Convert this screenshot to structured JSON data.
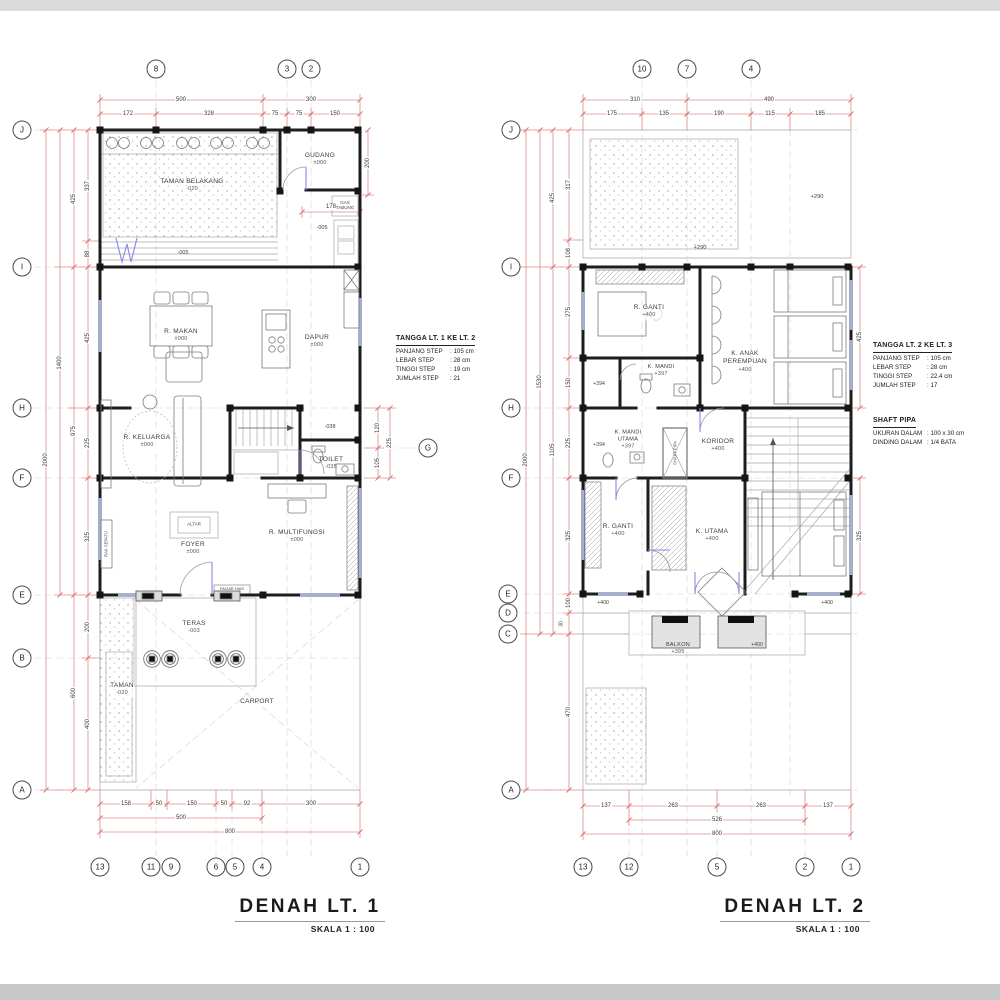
{
  "left": {
    "title": "DENAH LT. 1",
    "scale": "SKALA 1 : 100",
    "bubbles_top": [
      "8",
      "3",
      "2"
    ],
    "bubbles_bottom": [
      "13",
      "11",
      "9",
      "6",
      "5",
      "4",
      "1"
    ],
    "rows": [
      "J",
      "I",
      "H",
      "F",
      "E",
      "B",
      "A"
    ],
    "row_right": "G",
    "dims_top": [
      "500",
      "300"
    ],
    "dims_top2": [
      "172",
      "328",
      "75",
      "75",
      "150"
    ],
    "dims_bottom": [
      "158",
      "50",
      "150",
      "50",
      "92",
      "300"
    ],
    "dims_bottom2": [
      "500",
      "800"
    ],
    "dims_left": [
      "337",
      "88",
      "425",
      "225",
      "325",
      "200",
      "400"
    ],
    "dims_left2": [
      "425",
      "975",
      "600"
    ],
    "dim_span1": "1400",
    "dim_span2": "2000",
    "dims_right": [
      "200",
      "178",
      "120",
      "225",
      "105"
    ],
    "rooms": [
      {
        "n": "TAMAN BELAKANG",
        "l": "-020"
      },
      {
        "n": "GUDANG",
        "l": "±000"
      },
      {
        "n": "R. MAKAN",
        "l": "±000"
      },
      {
        "n": "DAPUR",
        "l": "±000"
      },
      {
        "n": "R. KELUARGA",
        "l": "±000"
      },
      {
        "n": "TOILET",
        "l": "-035"
      },
      {
        "n": "FOYER",
        "l": "±000"
      },
      {
        "n": "R. MULTIFUNGSI",
        "l": "±000"
      },
      {
        "n": "TERAS",
        "l": "-003"
      },
      {
        "n": "TAMAN",
        "l": "-020"
      },
      {
        "n": "CARPORT",
        "l": ""
      }
    ],
    "labels": {
      "gas1": "GAS",
      "gas2": "TABUNG",
      "deck": "-005",
      "deck2": "-005",
      "hall": "-038",
      "rak": "RAK SEPATU",
      "altar": "ALTAR",
      "pagar": "PAGAR HIAS"
    },
    "stair_note": {
      "title": "TANGGA LT. 1 KE LT. 2",
      "rows": [
        {
          "k": "PANJANG STEP",
          "v": ": 105 cm"
        },
        {
          "k": "LEBAR STEP",
          "v": ": 28 cm"
        },
        {
          "k": "TINGGI STEP",
          "v": ": 19 cm"
        },
        {
          "k": "JUMLAH STEP",
          "v": ": 21"
        }
      ]
    }
  },
  "right": {
    "title": "DENAH LT. 2",
    "scale": "SKALA 1 : 100",
    "bubbles_top": [
      "10",
      "7",
      "4"
    ],
    "bubbles_bottom": [
      "13",
      "12",
      "5",
      "2",
      "1"
    ],
    "rows": [
      "J",
      "I",
      "H",
      "F",
      "E",
      "D",
      "C",
      "A"
    ],
    "dims_top": [
      "310",
      "490"
    ],
    "dims_top2": [
      "175",
      "135",
      "190",
      "115",
      "185"
    ],
    "dims_bottom": [
      "137",
      "263",
      "263",
      "137"
    ],
    "dims_bottom2": [
      "526",
      "800"
    ],
    "dims_left": [
      "317",
      "108",
      "275",
      "150",
      "225",
      "325",
      "100",
      "30",
      "470"
    ],
    "dims_left2": [
      "425",
      "1105"
    ],
    "dim_span1": "1530",
    "dim_span2": "2000",
    "dims_right": [
      "425",
      "325"
    ],
    "rooms": [
      {
        "n": "R. GANTI",
        "l": "+400"
      },
      {
        "n": "K. MANDI",
        "l": "+397"
      },
      {
        "n": "K. ANAK",
        "n2": "PEREMPUAN",
        "l": "+400"
      },
      {
        "n": "K. MANDI",
        "n2": "UTAMA",
        "l": "+397"
      },
      {
        "n": "KORIDOR",
        "l": "+400"
      },
      {
        "n": "R. GANTI",
        "l": "+400"
      },
      {
        "n": "K. UTAMA",
        "l": "+400"
      },
      {
        "n": "BALKON",
        "l": "+395"
      }
    ],
    "levels": [
      "+290",
      "+290",
      "+394",
      "+394",
      "+400",
      "+400",
      "+400"
    ],
    "labels": {
      "shaft": "SHAFT PIPA"
    },
    "stair_note": {
      "title": "TANGGA LT. 2 KE LT. 3",
      "rows": [
        {
          "k": "PANJANG STEP",
          "v": ": 105 cm"
        },
        {
          "k": "LEBAR STEP",
          "v": ": 28 cm"
        },
        {
          "k": "TINGGI STEP",
          "v": ": 22.4 cm"
        },
        {
          "k": "JUMLAH STEP",
          "v": ": 17"
        }
      ]
    },
    "shaft_note": {
      "title": "SHAFT PIPA",
      "rows": [
        {
          "k": "UKURAN DALAM",
          "v": ": 100 x 30 cm"
        },
        {
          "k": "DINDING DALAM",
          "v": ": 1/4 BATA"
        }
      ]
    }
  }
}
